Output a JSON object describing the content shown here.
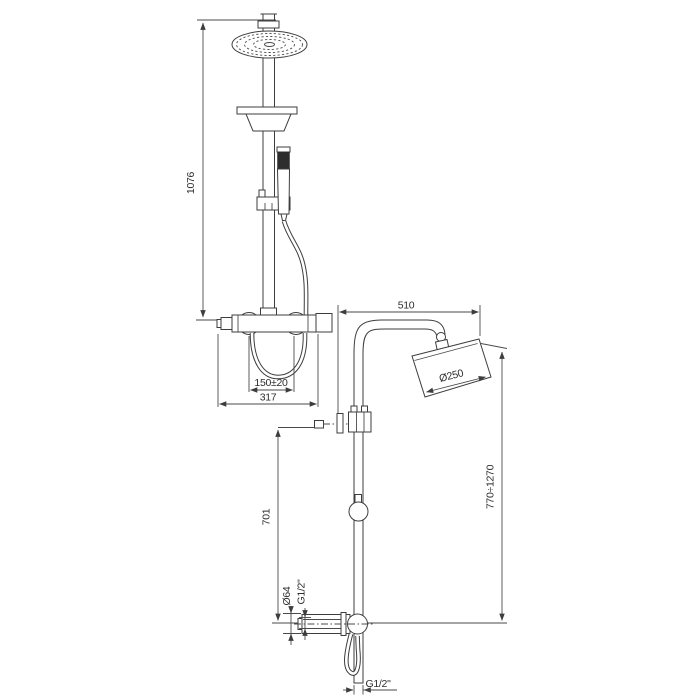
{
  "title": "Shower column technical drawing",
  "colors": {
    "line": "#3d3d3d",
    "text": "#2e2e2e",
    "background": "#ffffff"
  },
  "front": {
    "dims": {
      "overall_height": "1076",
      "inlet_spacing": "150±20",
      "total_width": "317"
    }
  },
  "side": {
    "dims": {
      "reach": "510",
      "head_diameter": "Ø250",
      "height_range": "770÷1270",
      "bracket_to_valve": "701",
      "valve_body_diameter": "Ø64",
      "valve_connection_thread": "G1/2\"",
      "bottom_connection_thread": "G1/2\""
    }
  }
}
